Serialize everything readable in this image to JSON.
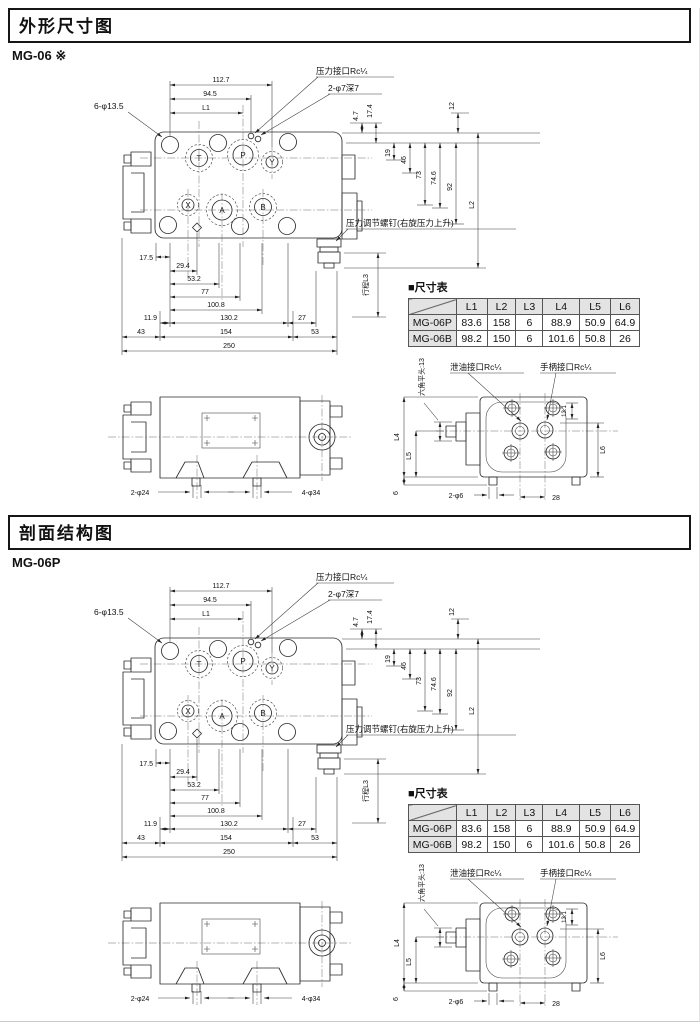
{
  "page": {
    "background": "#ffffff"
  },
  "sections": [
    {
      "title": "外形尺寸图",
      "model": "MG-06 ※"
    },
    {
      "title": "剖面结构图",
      "model": "MG-06P"
    }
  ],
  "drawing": {
    "labels": {
      "bolt_holes": "6-φ13.5",
      "pressure_port": "压力接口Rc¼",
      "tap_holes": "2-φ7深7",
      "adjust_screw": "压力调节螺钉(右旋压力上升)",
      "stroke": "行程L3",
      "hex_head": "六角平头:13",
      "drain_port": "泄油接口Rc¼",
      "handle_port": "手柄接口Rc¼",
      "feet_small": "2-φ24",
      "feet_large": "4-φ34",
      "pin_small": "2-φ6"
    },
    "ports": {
      "t": "T",
      "p": "P",
      "y": "Y",
      "x": "X",
      "a": "A",
      "b": "B"
    },
    "dims": {
      "d112_7": "112.7",
      "d94_5": "94.5",
      "l1": "L1",
      "d4_7": "4.7",
      "d17_4": "17.4",
      "d12": "12",
      "d19": "19",
      "d46": "46",
      "d73": "73",
      "d74_6": "74.6",
      "d92": "92",
      "l2": "L2",
      "d17_5": "17.5",
      "d29_4": "29.4",
      "d53_2": "53.2",
      "d77": "77",
      "d100_8": "100.8",
      "d11_9": "11.9",
      "d130_2": "130.2",
      "d27": "27",
      "d43": "43",
      "d154": "154",
      "d53": "53",
      "d250": "250",
      "l4": "L4",
      "l5": "L5",
      "l6": "L6",
      "d6": "6",
      "d28": "28",
      "d13_1": "13.1"
    }
  },
  "table": {
    "title": "■尺寸表",
    "headers": [
      "L1",
      "L2",
      "L3",
      "L4",
      "L5",
      "L6"
    ],
    "rows": [
      {
        "model": "MG-06P",
        "values": [
          "83.6",
          "158",
          "6",
          "88.9",
          "50.9",
          "64.9"
        ]
      },
      {
        "model": "MG-06B",
        "values": [
          "98.2",
          "150",
          "6",
          "101.6",
          "50.8",
          "26"
        ]
      }
    ]
  }
}
